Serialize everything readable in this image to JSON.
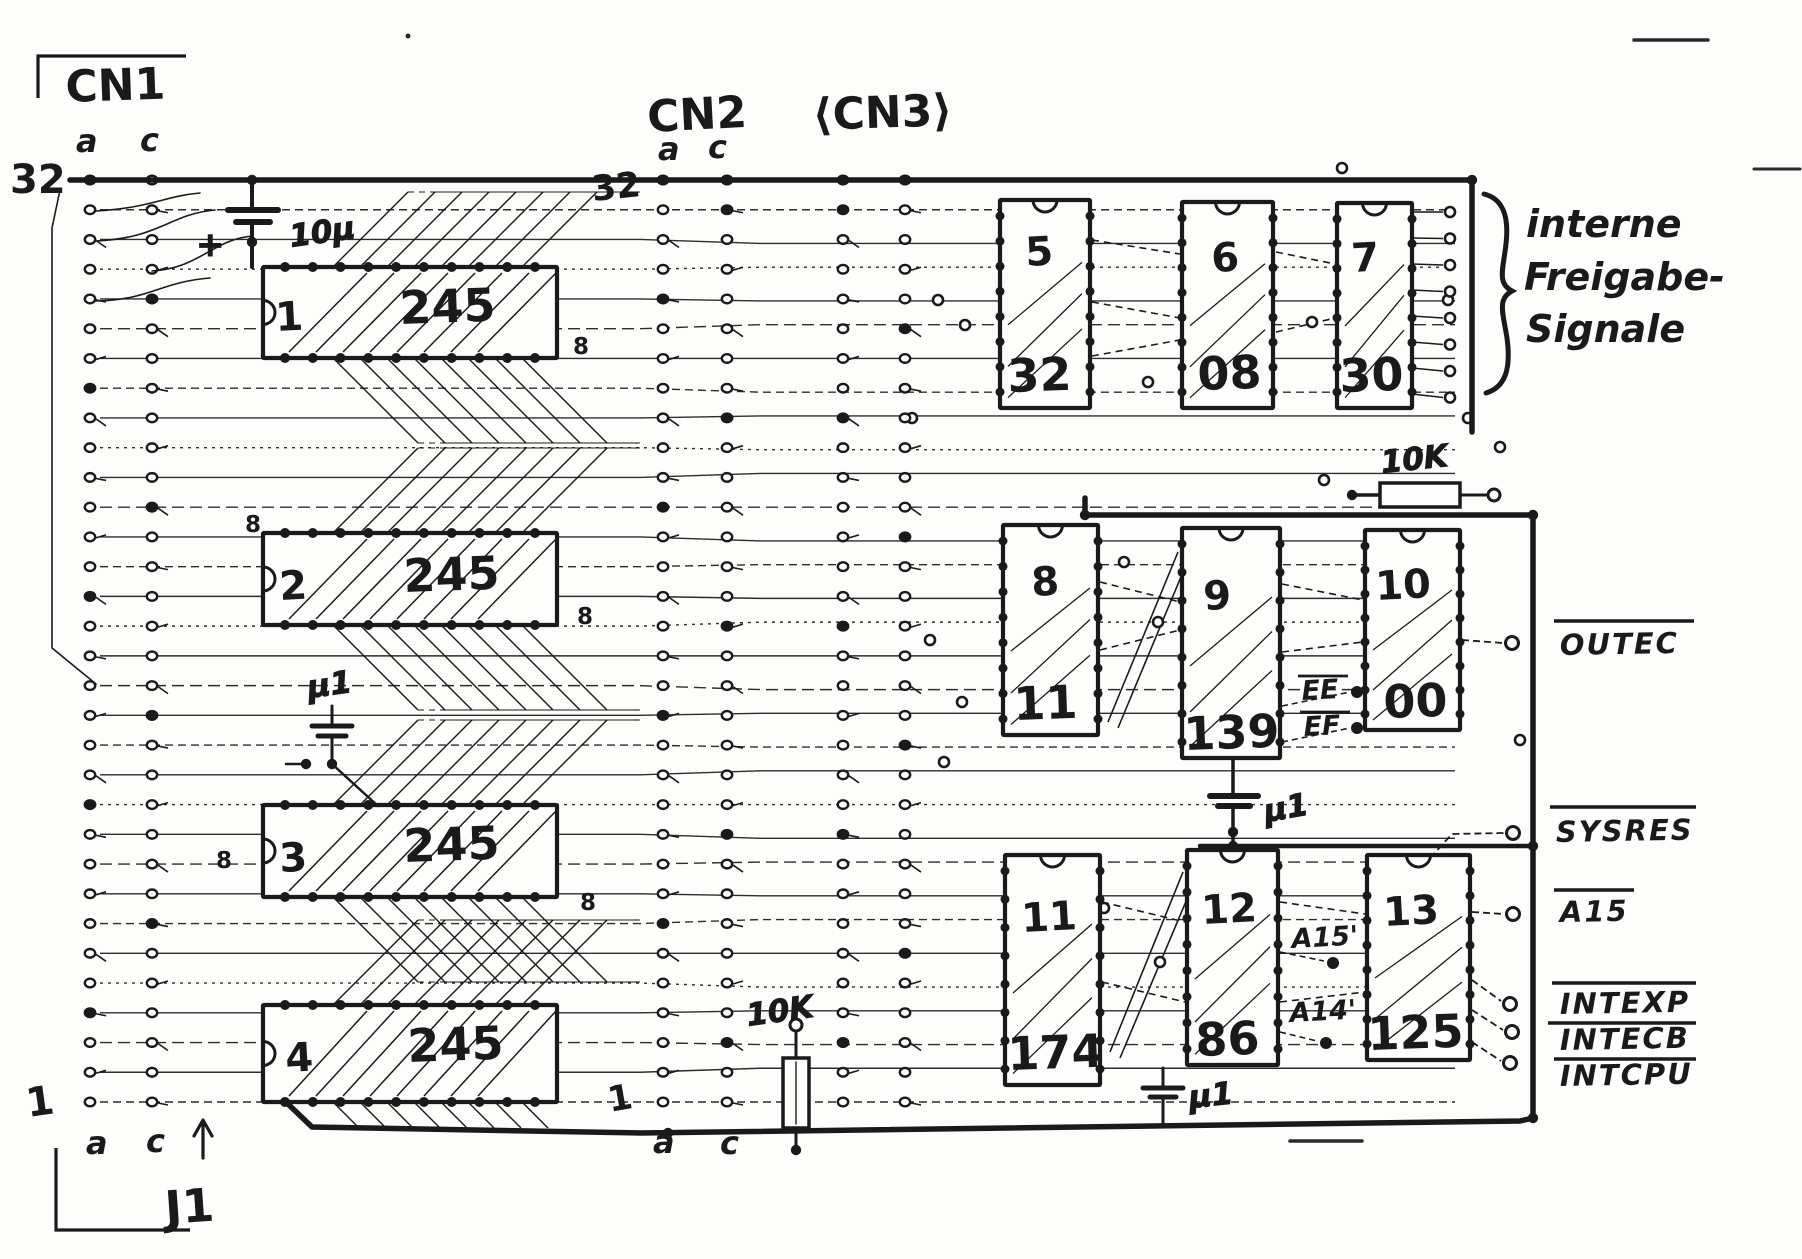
{
  "diagram": {
    "paper": "#fdfdfb",
    "ink": "#1a1a1a",
    "connectors": {
      "cn1": {
        "label": "CN1",
        "col_a": "a",
        "col_c": "c",
        "row_top": "32",
        "row_bottom": "1",
        "bottom_col_a": "a",
        "bottom_col_c": "c",
        "rows": 32
      },
      "cn2": {
        "label": "CN2",
        "col_a": "a",
        "col_c": "c",
        "row_top": "32",
        "row_bottom": "1",
        "bottom_col_a": "a",
        "bottom_col_c": "c",
        "rows": 32
      },
      "cn3": {
        "label": "⟨CN3⟩"
      }
    },
    "jumper": {
      "label": "J1"
    },
    "brace_note": {
      "line1": "interne",
      "line2": "Freigabe-",
      "line3": "Signale"
    },
    "chips": [
      {
        "ref": "1",
        "type": "245",
        "x": 263,
        "y": 267,
        "w": 294,
        "h": 91,
        "o": "h",
        "rx": 276,
        "ry": 331,
        "tx": 400,
        "ty": 324
      },
      {
        "ref": "2",
        "type": "245",
        "x": 263,
        "y": 533,
        "w": 294,
        "h": 92,
        "o": "h",
        "rx": 280,
        "ry": 600,
        "tx": 404,
        "ty": 592
      },
      {
        "ref": "3",
        "type": "245",
        "x": 263,
        "y": 805,
        "w": 294,
        "h": 92,
        "o": "h",
        "rx": 280,
        "ry": 872,
        "tx": 404,
        "ty": 862
      },
      {
        "ref": "4",
        "type": "245",
        "x": 263,
        "y": 1005,
        "w": 294,
        "h": 97,
        "o": "h",
        "rx": 286,
        "ry": 1072,
        "tx": 408,
        "ty": 1062
      },
      {
        "ref": "5",
        "type": "32",
        "x": 1000,
        "y": 200,
        "w": 90,
        "h": 208,
        "o": "v",
        "rx": 1026,
        "ry": 266,
        "tx": 1008,
        "ty": 392
      },
      {
        "ref": "6",
        "type": "08",
        "x": 1182,
        "y": 202,
        "w": 91,
        "h": 206,
        "o": "v",
        "rx": 1212,
        "ry": 272,
        "tx": 1198,
        "ty": 390
      },
      {
        "ref": "7",
        "type": "30",
        "x": 1337,
        "y": 203,
        "w": 75,
        "h": 205,
        "o": "v",
        "rx": 1352,
        "ry": 272,
        "tx": 1340,
        "ty": 392
      },
      {
        "ref": "8",
        "type": "11",
        "x": 1003,
        "y": 525,
        "w": 95,
        "h": 210,
        "o": "v",
        "rx": 1032,
        "ry": 596,
        "tx": 1014,
        "ty": 720
      },
      {
        "ref": "9",
        "type": "139",
        "x": 1182,
        "y": 528,
        "w": 98,
        "h": 230,
        "o": "v",
        "rx": 1204,
        "ry": 610,
        "tx": 1184,
        "ty": 750
      },
      {
        "ref": "10",
        "type": "00",
        "x": 1365,
        "y": 530,
        "w": 95,
        "h": 200,
        "o": "v",
        "rx": 1376,
        "ry": 600,
        "tx": 1384,
        "ty": 718
      },
      {
        "ref": "11",
        "type": "174",
        "x": 1005,
        "y": 855,
        "w": 95,
        "h": 230,
        "o": "v",
        "rx": 1022,
        "ry": 932,
        "tx": 1008,
        "ty": 1070
      },
      {
        "ref": "12",
        "type": "86",
        "x": 1187,
        "y": 850,
        "w": 91,
        "h": 215,
        "o": "v",
        "rx": 1202,
        "ry": 924,
        "tx": 1196,
        "ty": 1056
      },
      {
        "ref": "13",
        "type": "125",
        "x": 1367,
        "y": 855,
        "w": 103,
        "h": 205,
        "o": "v",
        "rx": 1384,
        "ry": 926,
        "tx": 1368,
        "ty": 1050
      }
    ],
    "signals": [
      {
        "label": "OUTEC",
        "tx": 1560,
        "ty": 655,
        "ol": [
          1554,
          1694,
          621
        ],
        "pad": [
          1512,
          643
        ],
        "lead": "M1462,640 L1503,643"
      },
      {
        "label": "SYSRES",
        "tx": 1556,
        "ty": 842,
        "ol": [
          1550,
          1696,
          807
        ],
        "pad": [
          1513,
          833
        ],
        "lead": "M1430,858 L1452,834 L1504,833"
      },
      {
        "label": "A15",
        "tx": 1560,
        "ty": 922,
        "ol": [
          1554,
          1634,
          890
        ],
        "pad": [
          1513,
          914
        ],
        "lead": "M1472,912 L1504,914"
      },
      {
        "label": "INTEXP",
        "tx": 1560,
        "ty": 1014,
        "ol": [
          1552,
          1696,
          983
        ],
        "pad": [
          1510,
          1004
        ],
        "lead": "M1472,980 L1501,1001"
      },
      {
        "label": "INTECB",
        "tx": 1560,
        "ty": 1050,
        "ol": [
          1548,
          1696,
          1023
        ],
        "pad": [
          1512,
          1032
        ],
        "lead": "M1472,1010 L1503,1030"
      },
      {
        "label": "INTCPU",
        "tx": 1560,
        "ty": 1086,
        "ol": [
          1554,
          1696,
          1059
        ],
        "pad": [
          1510,
          1063
        ],
        "lead": "M1472,1042 L1501,1061"
      }
    ],
    "nets": [
      {
        "label": "EE",
        "tx": 1302,
        "ty": 700,
        "ol": [
          1298,
          1348,
          676
        ],
        "dot": [
          1357,
          692
        ],
        "lead": "M1282,706 L1350,692"
      },
      {
        "label": "EF",
        "tx": 1304,
        "ty": 736,
        "ol": [
          1300,
          1350,
          712
        ],
        "dot": [
          1357,
          728
        ],
        "lead": "M1282,742 L1350,728"
      },
      {
        "label": "A15'",
        "tx": 1292,
        "ty": 948,
        "dot": [
          1333,
          963
        ],
        "lead": "M1280,952 L1324,961"
      },
      {
        "label": "A14'",
        "tx": 1290,
        "ty": 1022,
        "dot": [
          1326,
          1043
        ],
        "lead": "M1280,1032 L1317,1041"
      }
    ],
    "components": {
      "cap10u": {
        "label": "10µ",
        "polarity": "+"
      },
      "cap_mu1_left": {
        "label": "µ1"
      },
      "cap_mu1_mid": {
        "label": "µ1"
      },
      "cap_mu1_bottom": {
        "label": "µ1"
      },
      "res10k_top": {
        "label": "10K"
      },
      "res10k_bottom": {
        "label": "10K"
      }
    },
    "pin_marks": [
      {
        "label": "8",
        "x": 573,
        "y": 354
      },
      {
        "label": "8",
        "x": 245,
        "y": 532
      },
      {
        "label": "8",
        "x": 577,
        "y": 624
      },
      {
        "label": "8",
        "x": 216,
        "y": 868
      },
      {
        "label": "8",
        "x": 580,
        "y": 910
      }
    ],
    "layout": {
      "row_y_top": 180,
      "row_y_bottom": 1102,
      "rows": 32,
      "cn1_cols": [
        90,
        152
      ],
      "cn2_cols": [
        663,
        727
      ],
      "cn3_cols": [
        843,
        905
      ]
    }
  }
}
